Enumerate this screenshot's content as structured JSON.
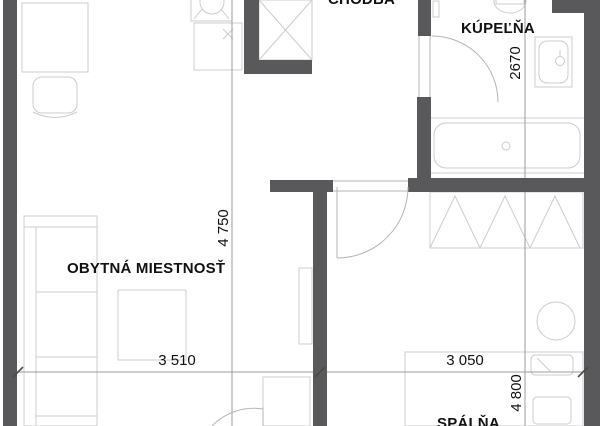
{
  "plan": {
    "rooms": [
      {
        "id": "chodba",
        "label": "CHODBA"
      },
      {
        "id": "kupelna",
        "label": "KÚPEĽŇA"
      },
      {
        "id": "obytna-miestnost",
        "label": "OBYTNÁ MIESTNOSŤ"
      },
      {
        "id": "spalna",
        "label": "SPÁLŇA"
      }
    ],
    "dimensions": [
      {
        "id": "kupelna-height",
        "value": "2670",
        "orientation": "vertical"
      },
      {
        "id": "obytna-height",
        "value": "4 750",
        "orientation": "vertical"
      },
      {
        "id": "obytna-width",
        "value": "3 510",
        "orientation": "horizontal"
      },
      {
        "id": "spalna-width",
        "value": "3 050",
        "orientation": "horizontal"
      },
      {
        "id": "spalna-height",
        "value": "4 800",
        "orientation": "vertical"
      }
    ],
    "colors": {
      "wall": "#59595b",
      "furniture": "#cccccc",
      "dimension": "#9b9b9b",
      "door": "#b5b5b5",
      "tick": "#4a4a4a",
      "text": "#111111",
      "background": "#ffffff"
    }
  }
}
